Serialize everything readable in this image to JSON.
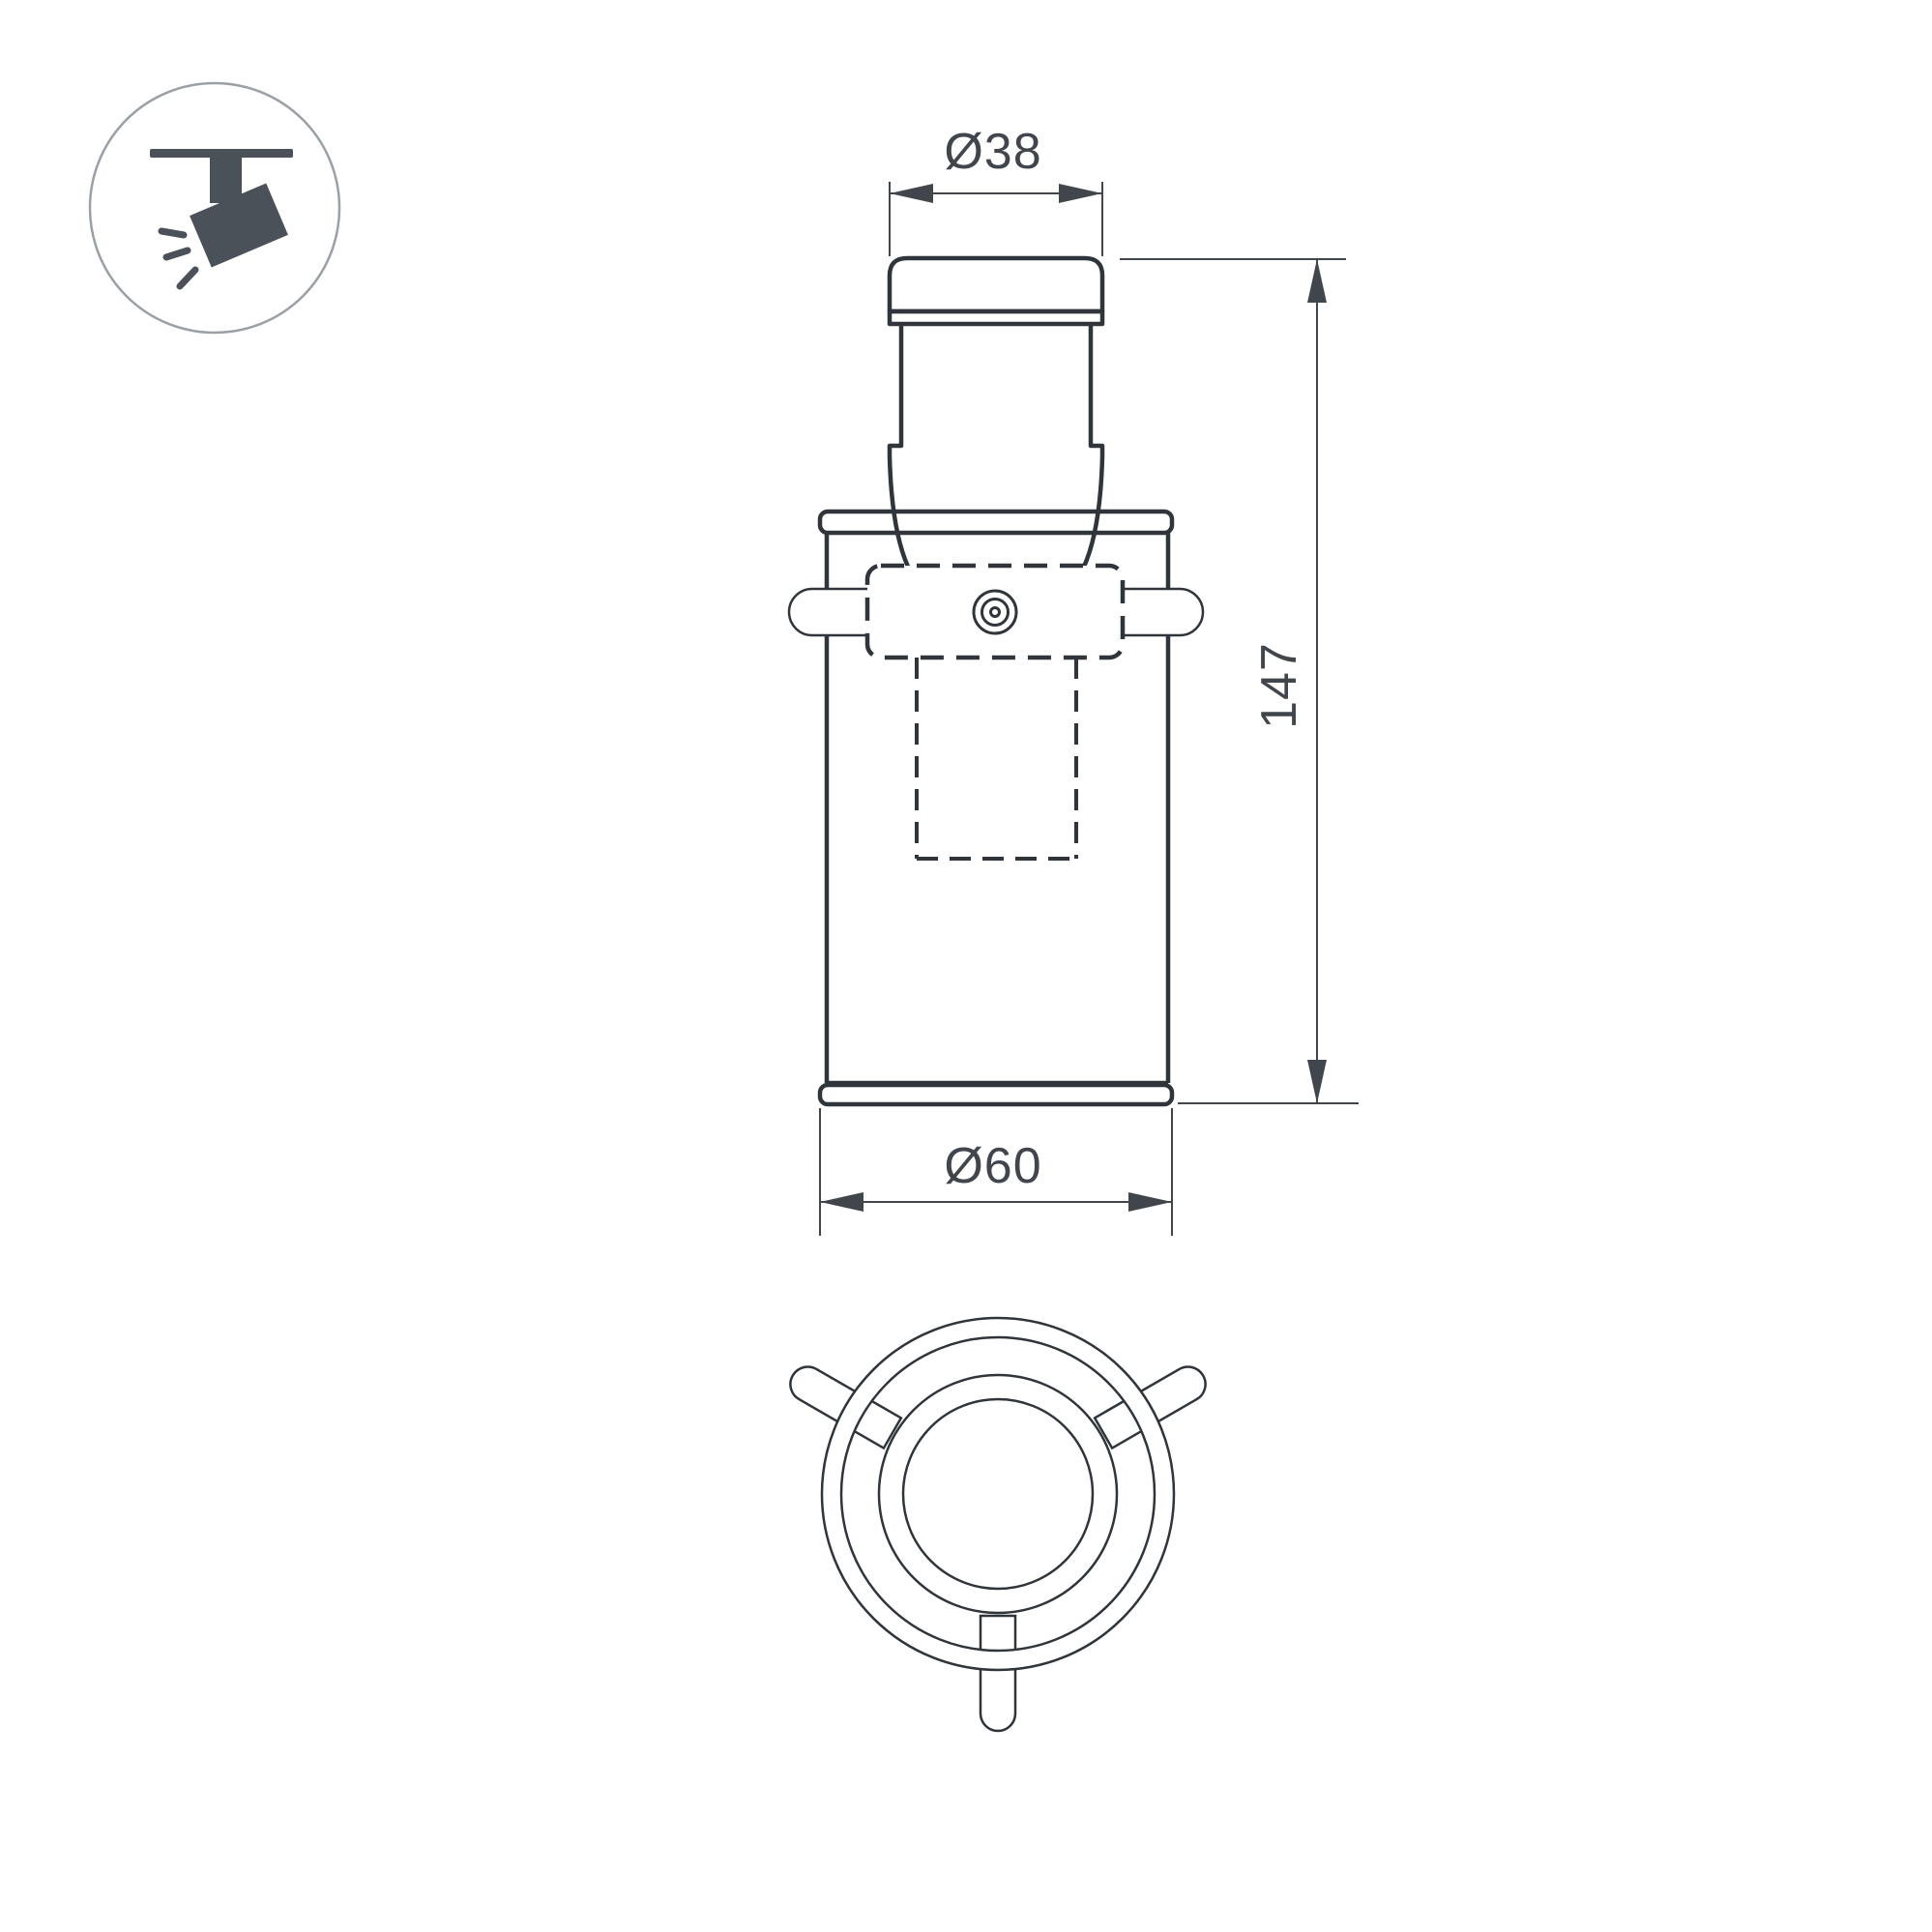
{
  "document": {
    "type": "technical-dimension-drawing",
    "subject": "track-spotlight-luminaire"
  },
  "colors": {
    "outline": "#2f353b",
    "dimension": "#40464c",
    "icon_dark": "#4a5158",
    "icon_circle": "#9aa0a6",
    "page_bg": "#ffffff"
  },
  "legend": {
    "icon": "track-spotlight"
  },
  "dimensions": {
    "top_diameter": "Ø38",
    "height": "147",
    "bottom_diameter": "Ø60"
  },
  "views": {
    "front": "front elevation with swivel bracket (dashed) and side pivot pins",
    "bottom": "plan view: 4 concentric circles with 3 radial pins at 120°"
  }
}
